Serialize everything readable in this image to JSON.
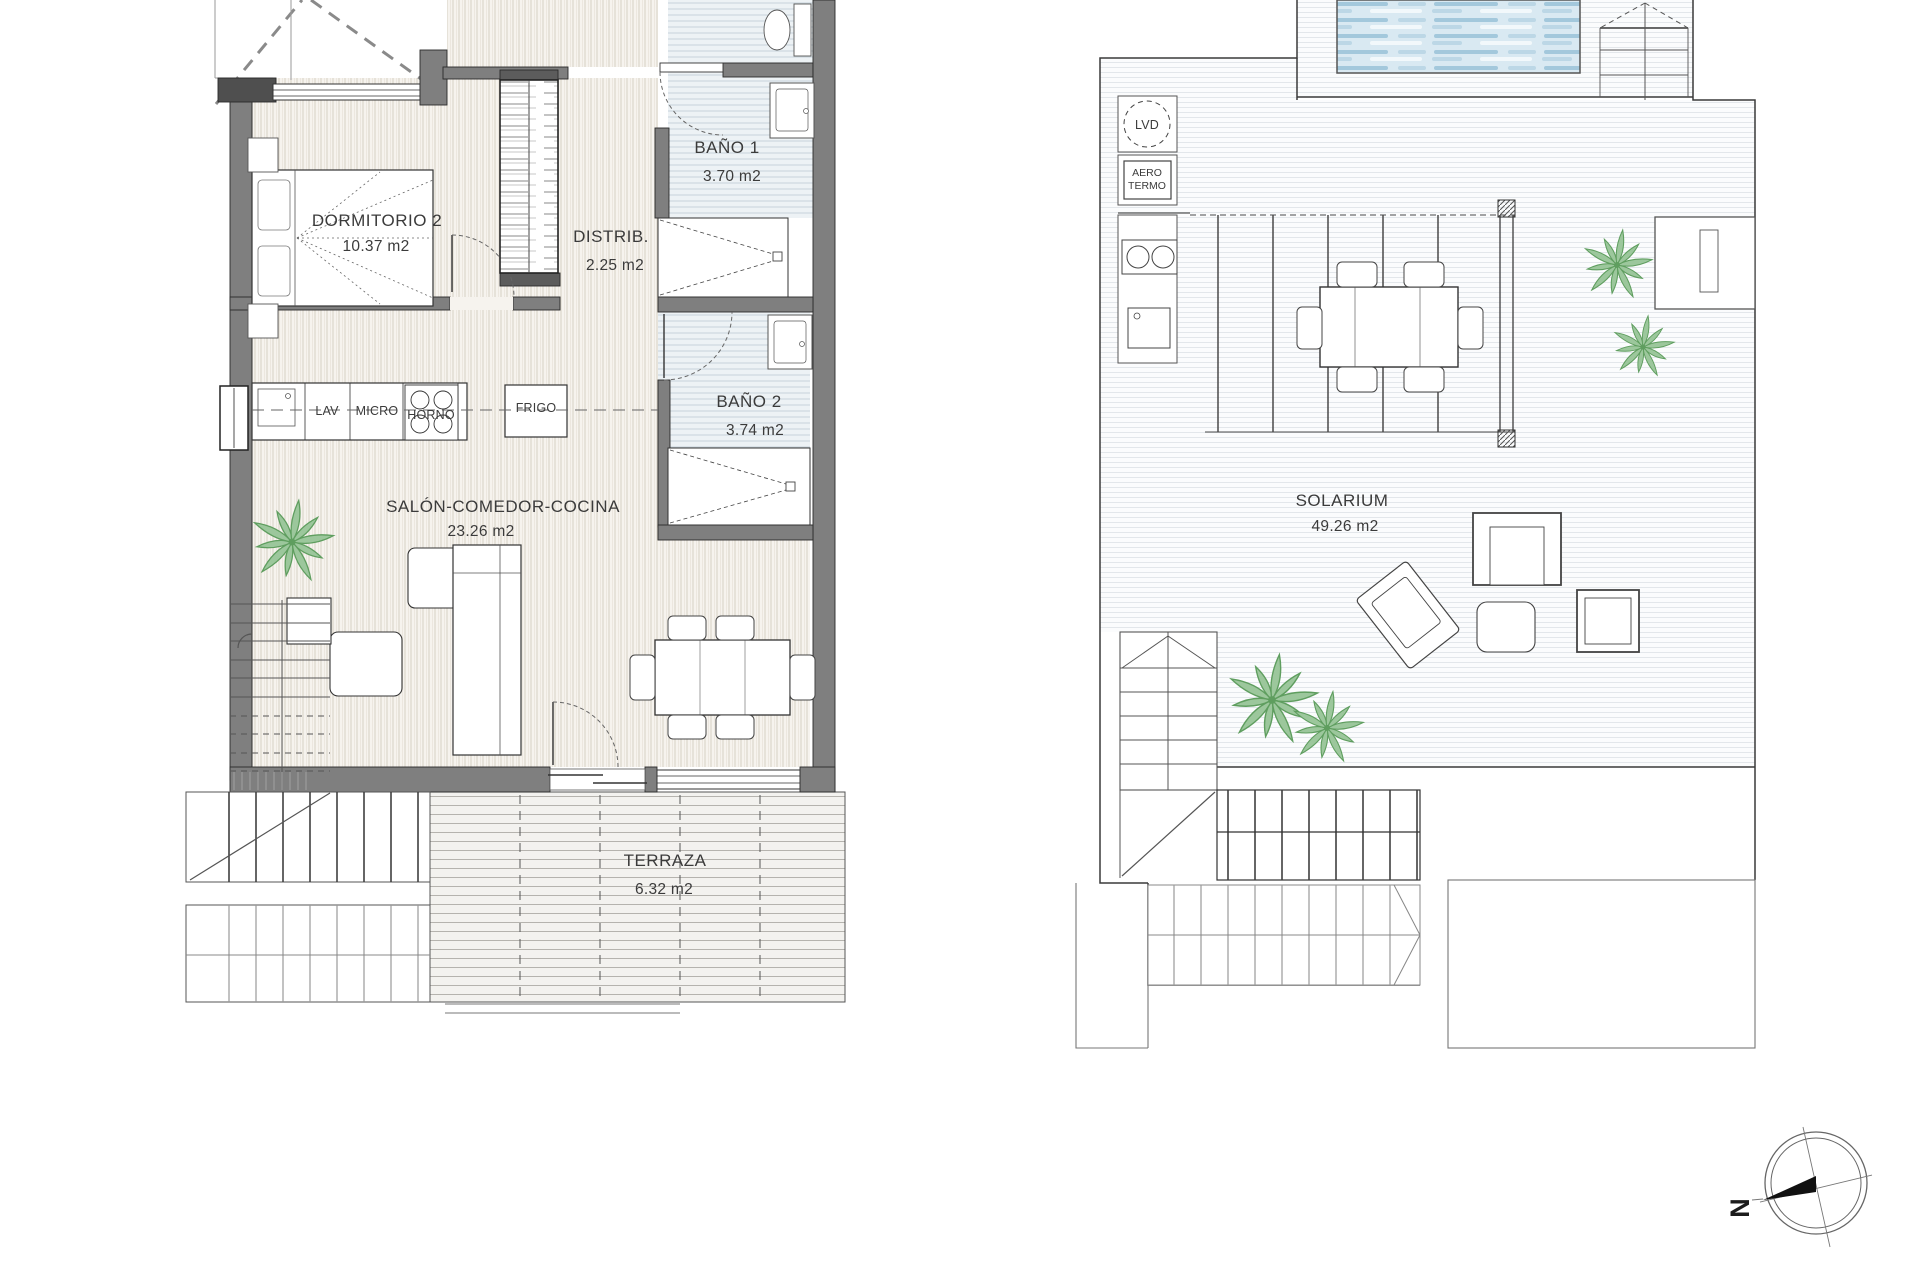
{
  "left_plan": {
    "rooms": {
      "dormitorio": {
        "name": "DORMITORIO 2",
        "area": "10.37 m2"
      },
      "distribuidor": {
        "name": "DISTRIB.",
        "area": "2.25 m2"
      },
      "bano1": {
        "name": "BAÑO 1",
        "area": "3.70 m2"
      },
      "bano2": {
        "name": "BAÑO 2",
        "area": "3.74 m2"
      },
      "salon": {
        "name": "SALÓN-COMEDOR-COCINA",
        "area": "23.26 m2"
      },
      "terraza": {
        "name": "TERRAZA",
        "area": "6.32 m2"
      }
    },
    "kitchen": {
      "lav": "LAV",
      "micro": "MICRO",
      "horno": "HORNO",
      "frigo": "FRIGO"
    }
  },
  "right_plan": {
    "rooms": {
      "solarium": {
        "name": "SOLARIUM",
        "area": "49.26 m2"
      }
    },
    "equipment": {
      "lvd": "LVD",
      "aero": "AERO",
      "termo": "TERMO"
    }
  },
  "compass": {
    "north": "N"
  },
  "colors": {
    "wall_gray": "#7f7f7f",
    "pool_water": "#d9e9f2",
    "pool_wave": "#a3c8dc",
    "plant_green": "#8fbf8f",
    "bath_floor_line": "#c8d3da",
    "wood_floor_line": "#d7d0c4"
  }
}
